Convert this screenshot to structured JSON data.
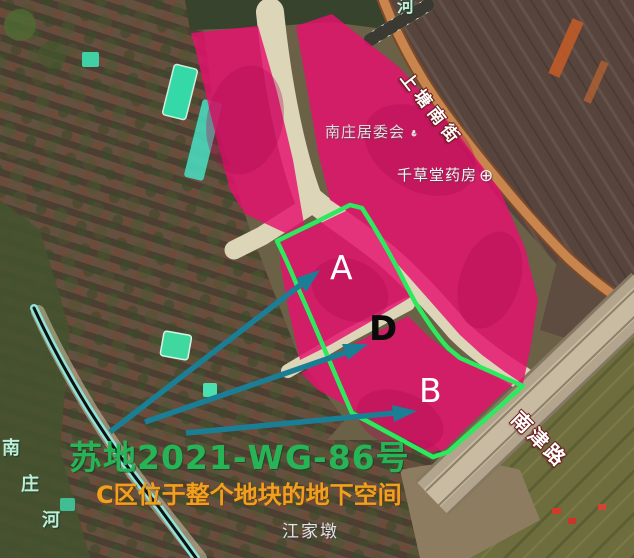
{
  "map": {
    "parcel_code": "苏地2021-WG-86号",
    "note": "C区位于整个地块的地下空间",
    "zones": {
      "a": "A",
      "b": "B",
      "d": "D"
    },
    "streets": {
      "shangtang": "上塘南街",
      "nanjin": "南津路",
      "river_name": "南庄河",
      "river_chars": [
        "南",
        "庄",
        "河"
      ],
      "river_partial_top": "河"
    },
    "pois": {
      "committee": "南庄居委会",
      "committee_dot": "·",
      "pharmacy": "千草堂药房",
      "pharmacy_icon": "⊕",
      "village": "江家墩"
    },
    "colors": {
      "parcel_pink": "#e8106e",
      "outline_green": "#2ee95e",
      "arrow_teal": "#1a7e95",
      "code_green": "#27b457",
      "note_orange": "#f0a01e",
      "river_mint": "#bdeed6"
    }
  }
}
